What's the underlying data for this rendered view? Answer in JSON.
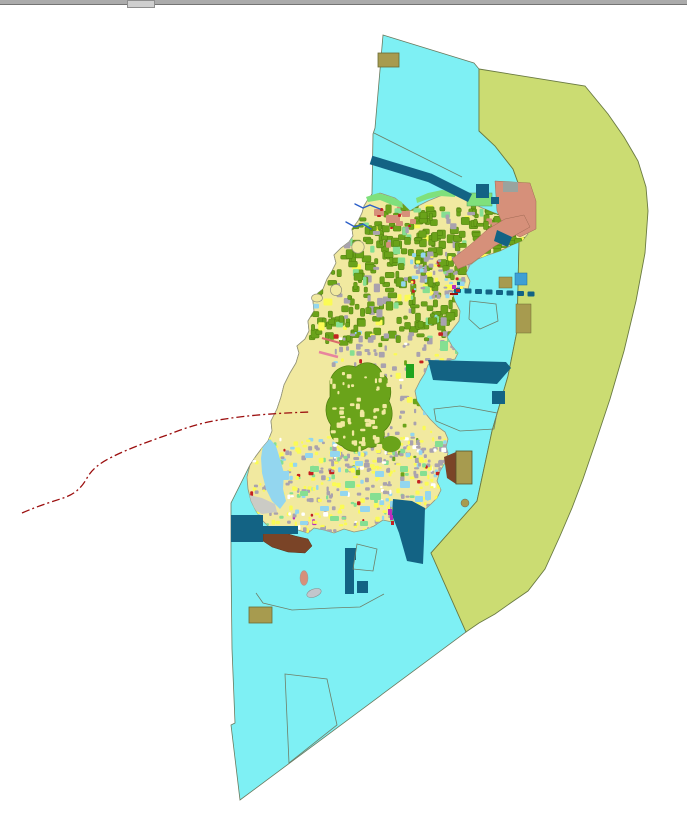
{
  "window": {
    "title": "",
    "scrollbar": {
      "orientation": "horizontal",
      "position": "top"
    }
  },
  "map": {
    "type": "land-use-planning-map",
    "visible_text": "",
    "regions": [
      {
        "name": "sea-planning-area",
        "color_key": "sea"
      },
      {
        "name": "eastern-outer-zone",
        "color_key": "easternZone"
      },
      {
        "name": "island-landmass",
        "color_key": "islandBase"
      },
      {
        "name": "forest-parcels",
        "color_key": "forest"
      },
      {
        "name": "urban-built-up",
        "color_key": "urbanGray"
      },
      {
        "name": "agricultural-parcels",
        "color_key": "lemon"
      },
      {
        "name": "development-zone",
        "color_key": "salmon"
      },
      {
        "name": "water-engineering",
        "color_key": "teal"
      },
      {
        "name": "port-reclamation",
        "color_key": "brown"
      },
      {
        "name": "special-use-blocks",
        "color_key": "khaki"
      },
      {
        "name": "administrative-boundary",
        "color_key": "darkRed"
      }
    ]
  },
  "colors": {
    "sea": "#7EF0F4",
    "easternZone": "#CBDC72",
    "islandBase": "#F1E9A0",
    "forest": "#6AA31A",
    "forestDark": "#4E7D0E",
    "urbanGray": "#A9A2AE",
    "lemon": "#FBFB55",
    "lightBlue": "#93D6EF",
    "lightGreen": "#85DF92",
    "coastGreen": "#7FE07C",
    "salmon": "#D6907A",
    "teal": "#136384",
    "brown": "#7A4427",
    "khaki": "#A79B4F",
    "mediumBlue": "#3E9FD4",
    "brightGreen": "#21A41E",
    "magenta": "#BC2FBC",
    "red": "#C42020",
    "darkRed": "#9B0E0E",
    "pink": "#E8849E",
    "creek": "#2B5FC8",
    "grayRect": "#9AA39E",
    "grayFlat": "#CBCBC5",
    "white": "#FFFFFF"
  }
}
